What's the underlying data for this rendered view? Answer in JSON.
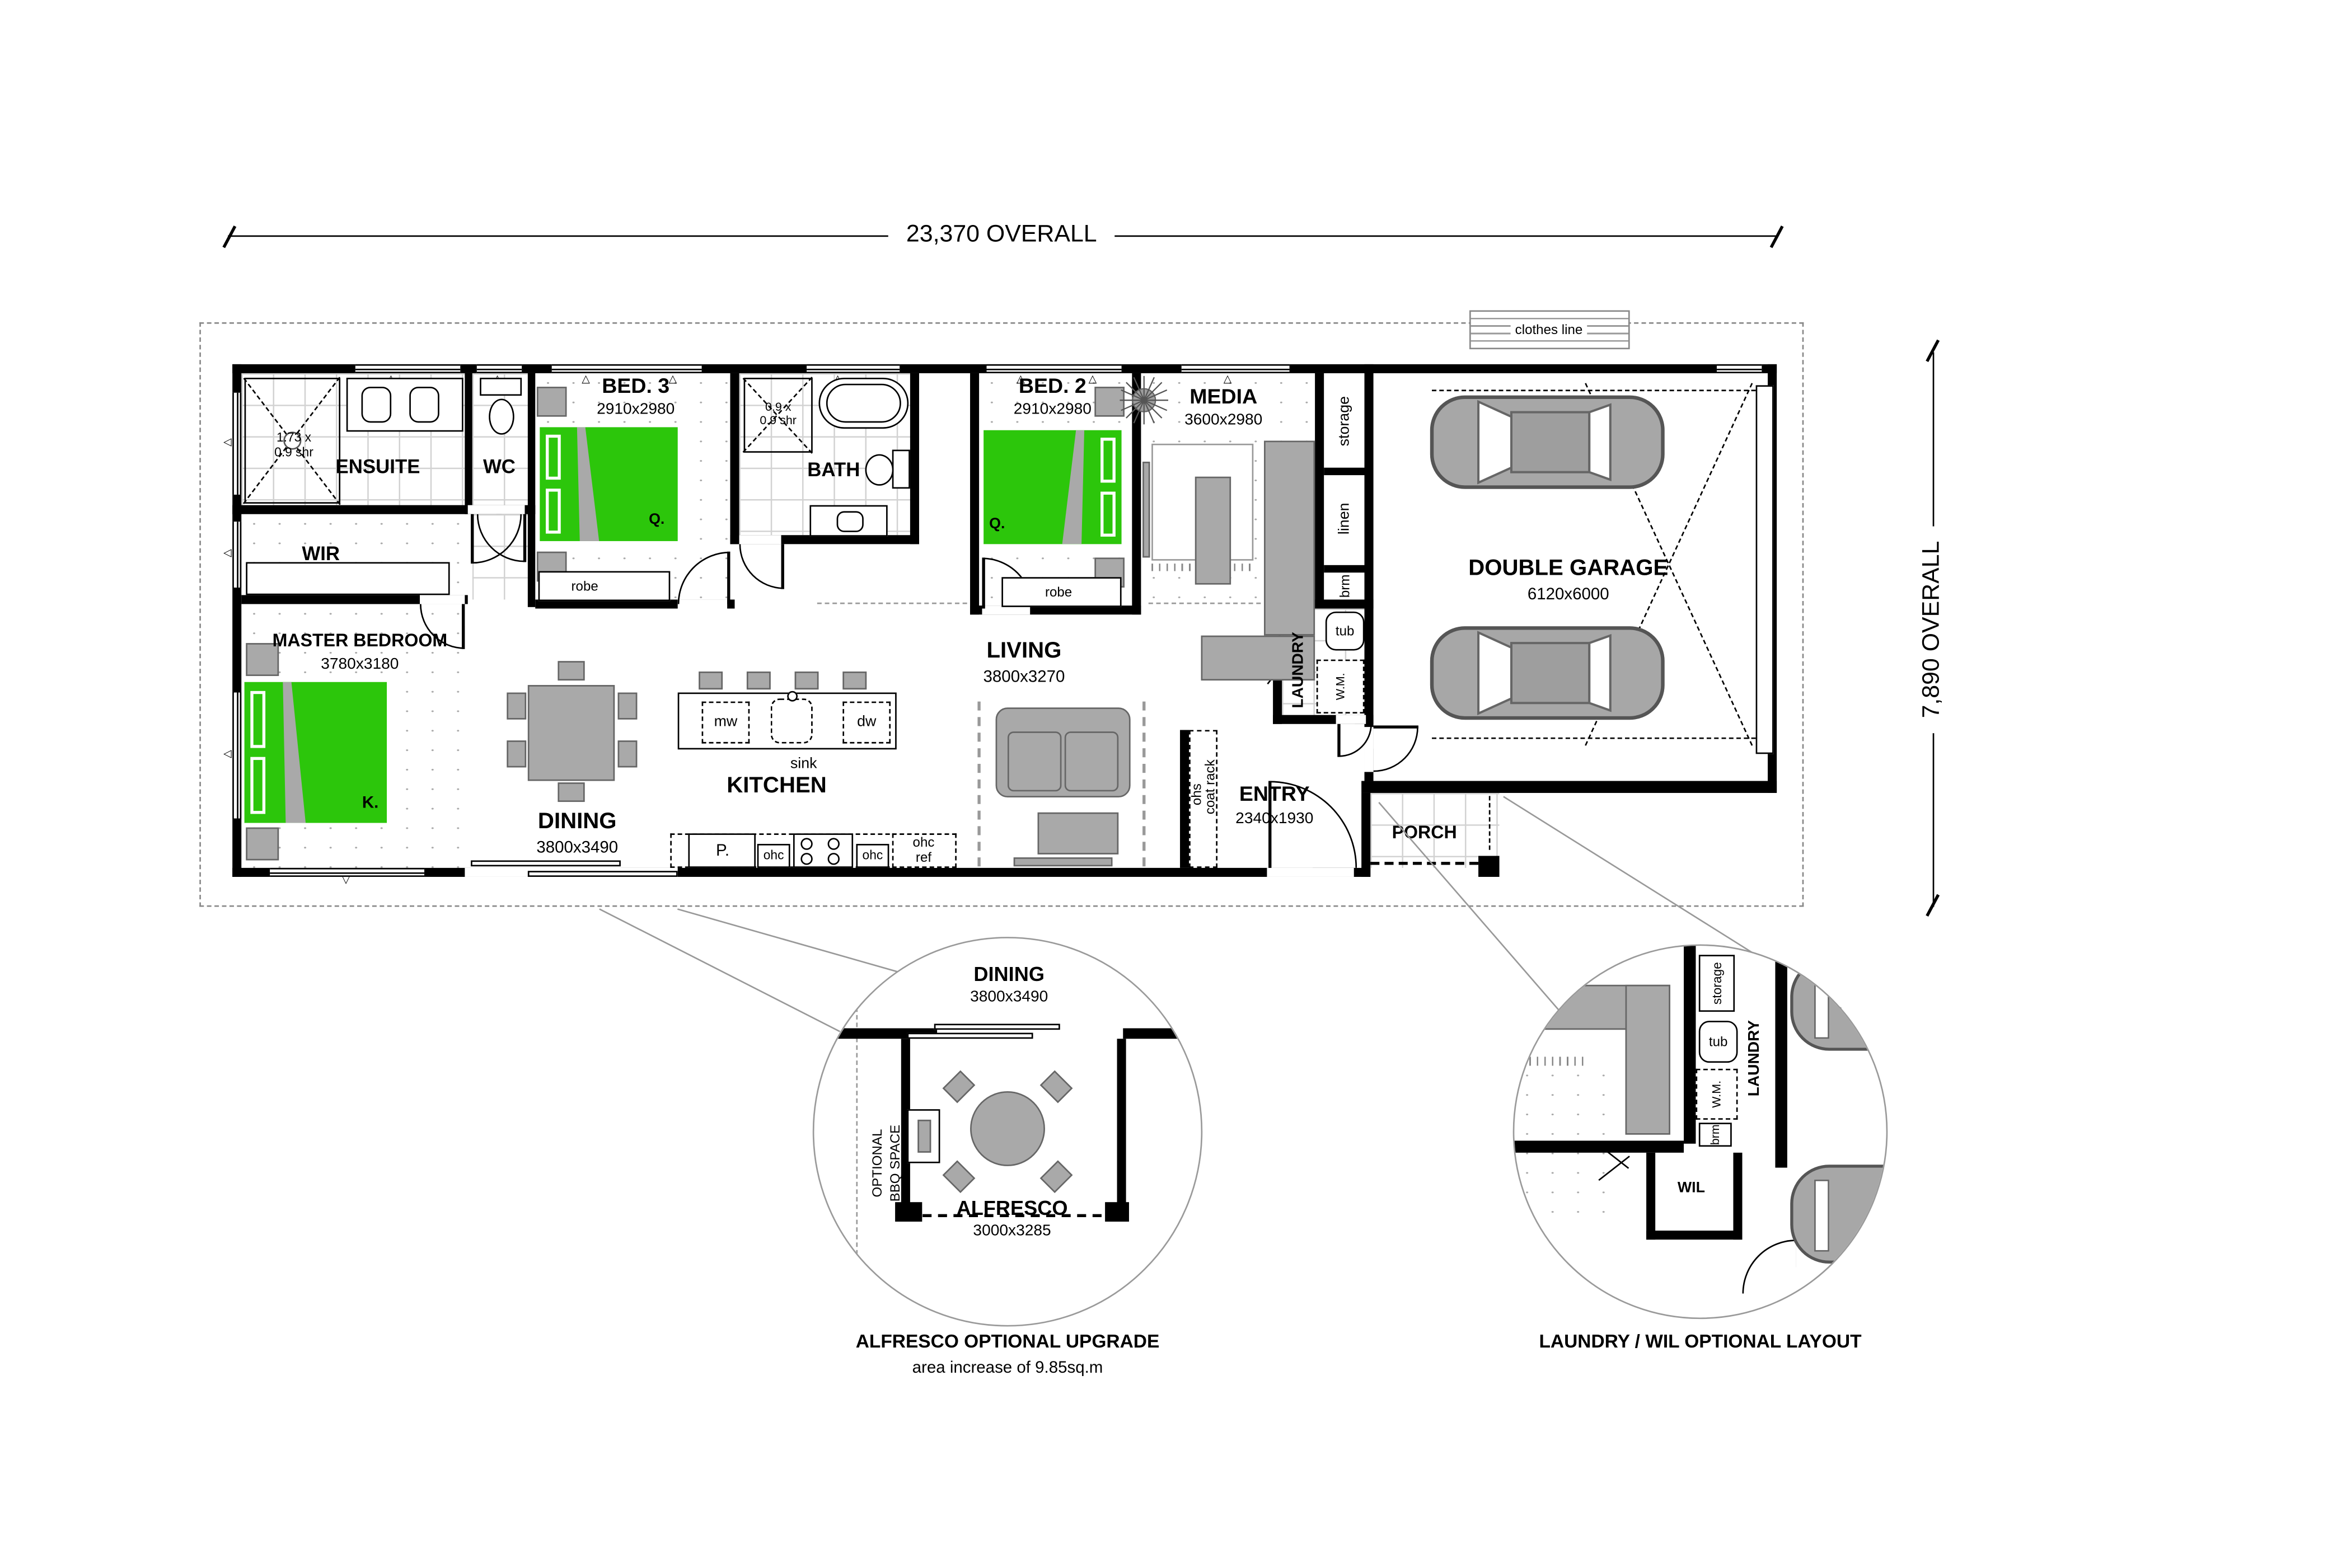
{
  "dimensions": {
    "overall_width": "23,370 OVERALL",
    "overall_depth": "7,890 OVERALL"
  },
  "site": {
    "clothes_line": "clothes line"
  },
  "rooms": {
    "ensuite": {
      "name": "ENSUITE",
      "shower": "1.73 x\n0.9 shr"
    },
    "wc": {
      "name": "WC"
    },
    "wir": {
      "name": "WIR"
    },
    "master_bedroom": {
      "name": "MASTER BEDROOM",
      "size": "3780x3180",
      "bed": "K."
    },
    "bed3": {
      "name": "BED. 3",
      "size": "2910x2980",
      "bed": "Q.",
      "robe": "robe"
    },
    "bath": {
      "name": "BATH",
      "shower": "0.9 x\n0.9 shr"
    },
    "bed2": {
      "name": "BED. 2",
      "size": "2910x2980",
      "bed": "Q.",
      "robe": "robe"
    },
    "media": {
      "name": "MEDIA",
      "size": "3600x2980"
    },
    "storage": "storage",
    "linen": "linen",
    "broom": "brm",
    "laundry": {
      "name": "LAUNDRY",
      "tub": "tub",
      "washing_machine": "W.M."
    },
    "garage": {
      "name": "DOUBLE GARAGE",
      "size": "6120x6000"
    },
    "living": {
      "name": "LIVING",
      "size": "3800x3270"
    },
    "kitchen": {
      "name": "KITCHEN",
      "sink": "sink",
      "microwave": "mw",
      "dishwasher": "dw",
      "pantry": "P.",
      "ohc": "ohc",
      "ohc_ref": "ohc\nref"
    },
    "dining": {
      "name": "DINING",
      "size": "3800x3490"
    },
    "entry": {
      "name": "ENTRY",
      "size": "2340x1930"
    },
    "porch": {
      "name": "PORCH"
    },
    "coat": {
      "ohs": "ohs",
      "rack": "coat rack"
    }
  },
  "details": {
    "alfresco": {
      "dining_name": "DINING",
      "dining_size": "3800x3490",
      "name": "ALFRESCO",
      "size": "3000x3285",
      "bbq_line1": "OPTIONAL",
      "bbq_line2": "BBQ SPACE",
      "caption": "ALFRESCO OPTIONAL UPGRADE",
      "note": "area increase of 9.85sq.m"
    },
    "laundry_wil": {
      "storage": "storage",
      "tub": "tub",
      "washing_machine": "W.M.",
      "broom": "brm",
      "laundry": "LAUNDRY",
      "wil": "WIL",
      "caption": "LAUNDRY / WIL OPTIONAL LAYOUT"
    }
  },
  "icons": {
    "window_up": "△",
    "window_left": "◁",
    "window_down": "▽"
  },
  "colors": {
    "bed_green": "#2cc60b",
    "furniture_gray": "#a9a9a9",
    "wall_black": "#000000"
  }
}
